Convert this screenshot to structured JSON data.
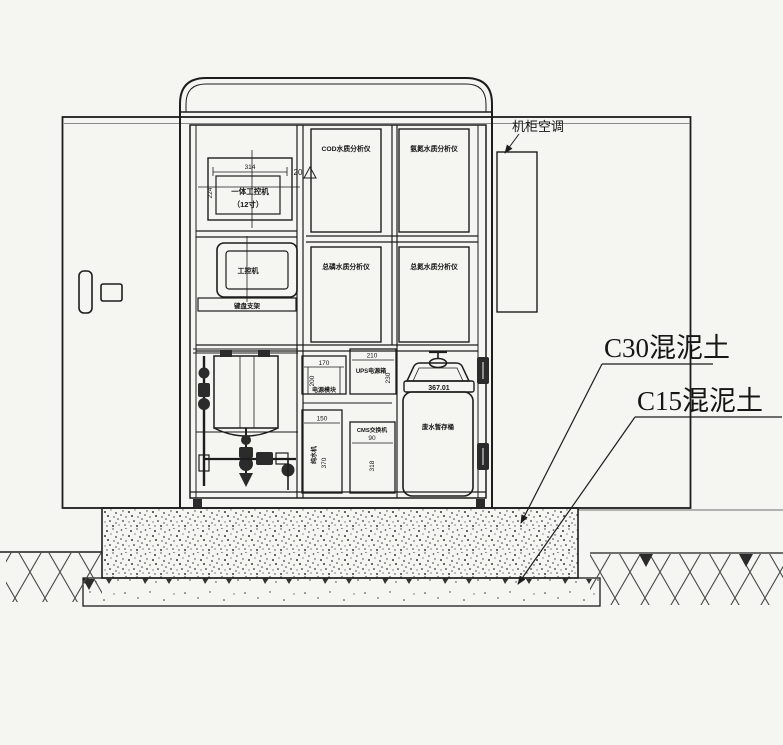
{
  "labels": {
    "ac_unit": "机柜空调",
    "concrete_c30": "C30混泥土",
    "concrete_c15": "C15混泥土"
  },
  "cabinet": {
    "ipc": {
      "dim_width": "314",
      "dim_height": "224",
      "name": "一体工控机",
      "size_note": "（12寸）"
    },
    "monitor_label": "工控机",
    "shelf_label": "键盘支架",
    "slope_mark": "20",
    "analyzers": [
      "COD水质分析仪",
      "氨氮水质分析仪",
      "总磷水质分析仪",
      "总氮水质分析仪"
    ],
    "power_box": {
      "dim_width": "170",
      "dim_height": "200",
      "label": "电源模块"
    },
    "ups_box": {
      "dim_width": "210",
      "dim_height": "230",
      "label": "UPS电源箱"
    },
    "purifier_box": {
      "dim_width": "150",
      "dim_height": "370",
      "label": "纯水机"
    },
    "switch_box": {
      "label": "CMS交换机",
      "num": "90",
      "dim_height": "318"
    },
    "waste_tank": {
      "num": "367.01",
      "label": "废水暂存桶"
    }
  },
  "colors": {
    "line": "#1d1d1d",
    "paper": "#f5f5f2",
    "gray_line": "#8a8a8a"
  }
}
